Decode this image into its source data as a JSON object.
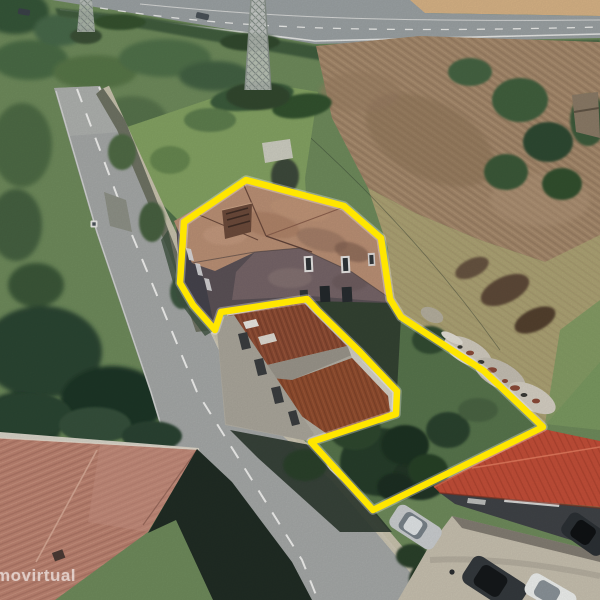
{
  "image": {
    "type": "aerial-photo",
    "description": "Oblique 3D aerial photograph of a roadside property: an old two-storey stone house and adjoining land outlined in yellow, beside a two-lane road, with a highway and plowed field behind and a red-roofed warehouse with parked cars in front."
  },
  "watermark": {
    "text": "movirtual"
  },
  "annotation": {
    "outline_color": "#ffe600",
    "outline_halo": "rgba(255,255,255,0.30)",
    "outline_width": "6.5",
    "outline_points": "246,180 344,206 381,238 390,299 401,317 484,371 543,427 373,510 311,442 396,414 397,391 360,352 318,311 307,299 221,312 215,330 193,305 180,283 184,222"
  },
  "palette": {
    "grass_mid": "#6e8a5b",
    "grass_light": "#86a465",
    "grass_dry": "#aba273",
    "tree_dark": "#273c2a",
    "highway_asphalt": "#9aa0a2",
    "dirt_tan": "#d6b285",
    "field_brown": "#a3876a",
    "road_asphalt": "#a4a7a6",
    "sidewalk": "#cbc4b1",
    "house_roof": "#b98f74",
    "house_wall": "#5a5156",
    "rust_roof": "#8a4a33",
    "warehouse_roof": "#c24e38",
    "bottomleft_roof": "#bb8270",
    "marking_white": "#ffffff"
  },
  "scene_elements": [
    "highway",
    "dirt-strip",
    "transmission-pylon-large",
    "transmission-pylon-small",
    "plowed-field",
    "hedgerow",
    "ruin-building",
    "local-road",
    "road-sign",
    "roadside-wall",
    "main-house",
    "neighbor-building",
    "parcel-yard",
    "debris-pile",
    "bottom-left-house",
    "warehouse-building",
    "parked-cars",
    "parcel-outline",
    "watermark"
  ]
}
